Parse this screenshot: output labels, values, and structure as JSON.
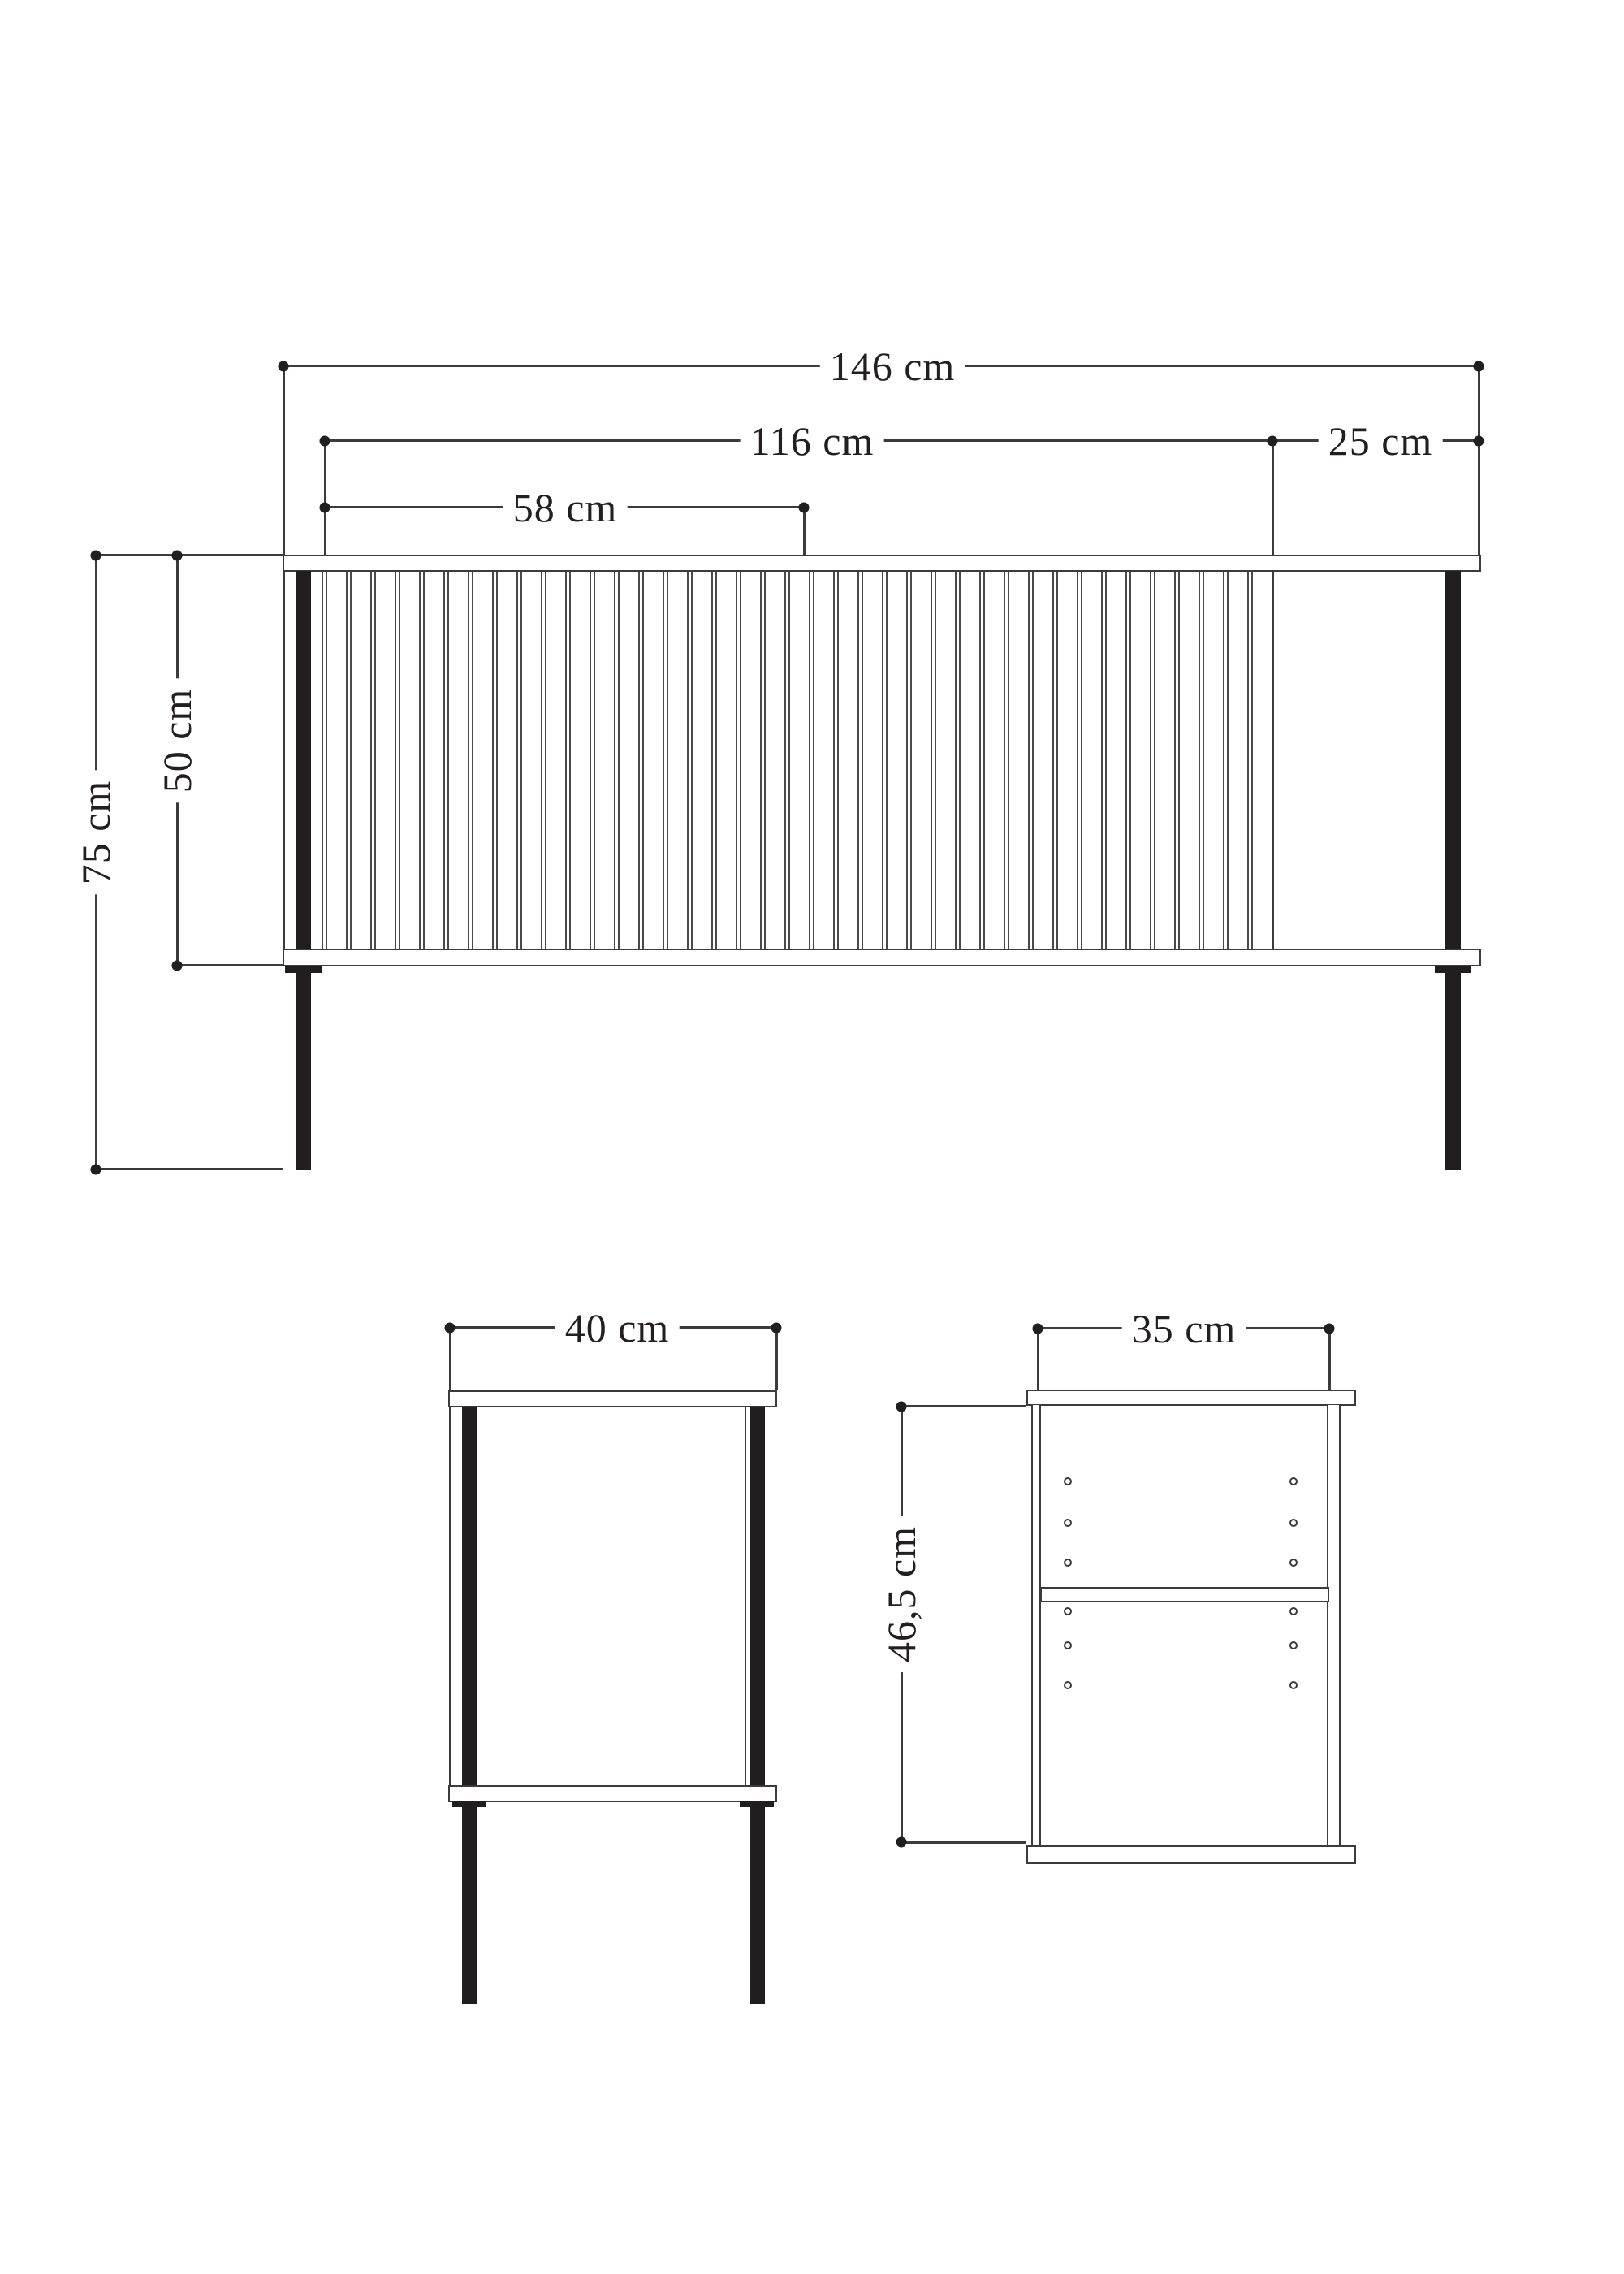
{
  "front_view": {
    "label_total_width": "146 cm",
    "label_slat_section_width": "116 cm",
    "label_open_section_width": "25 cm",
    "label_half_section_width": "58 cm",
    "label_body_height": "50 cm",
    "label_total_height": "75 cm"
  },
  "side_view": {
    "label_depth": "40 cm"
  },
  "section_view": {
    "label_inner_width": "35 cm",
    "label_inner_height": "46,5 cm"
  },
  "colors": {
    "line": "#3b3b3b",
    "leg_fill": "#211e1f",
    "text": "#231f20",
    "background": "#ffffff"
  }
}
